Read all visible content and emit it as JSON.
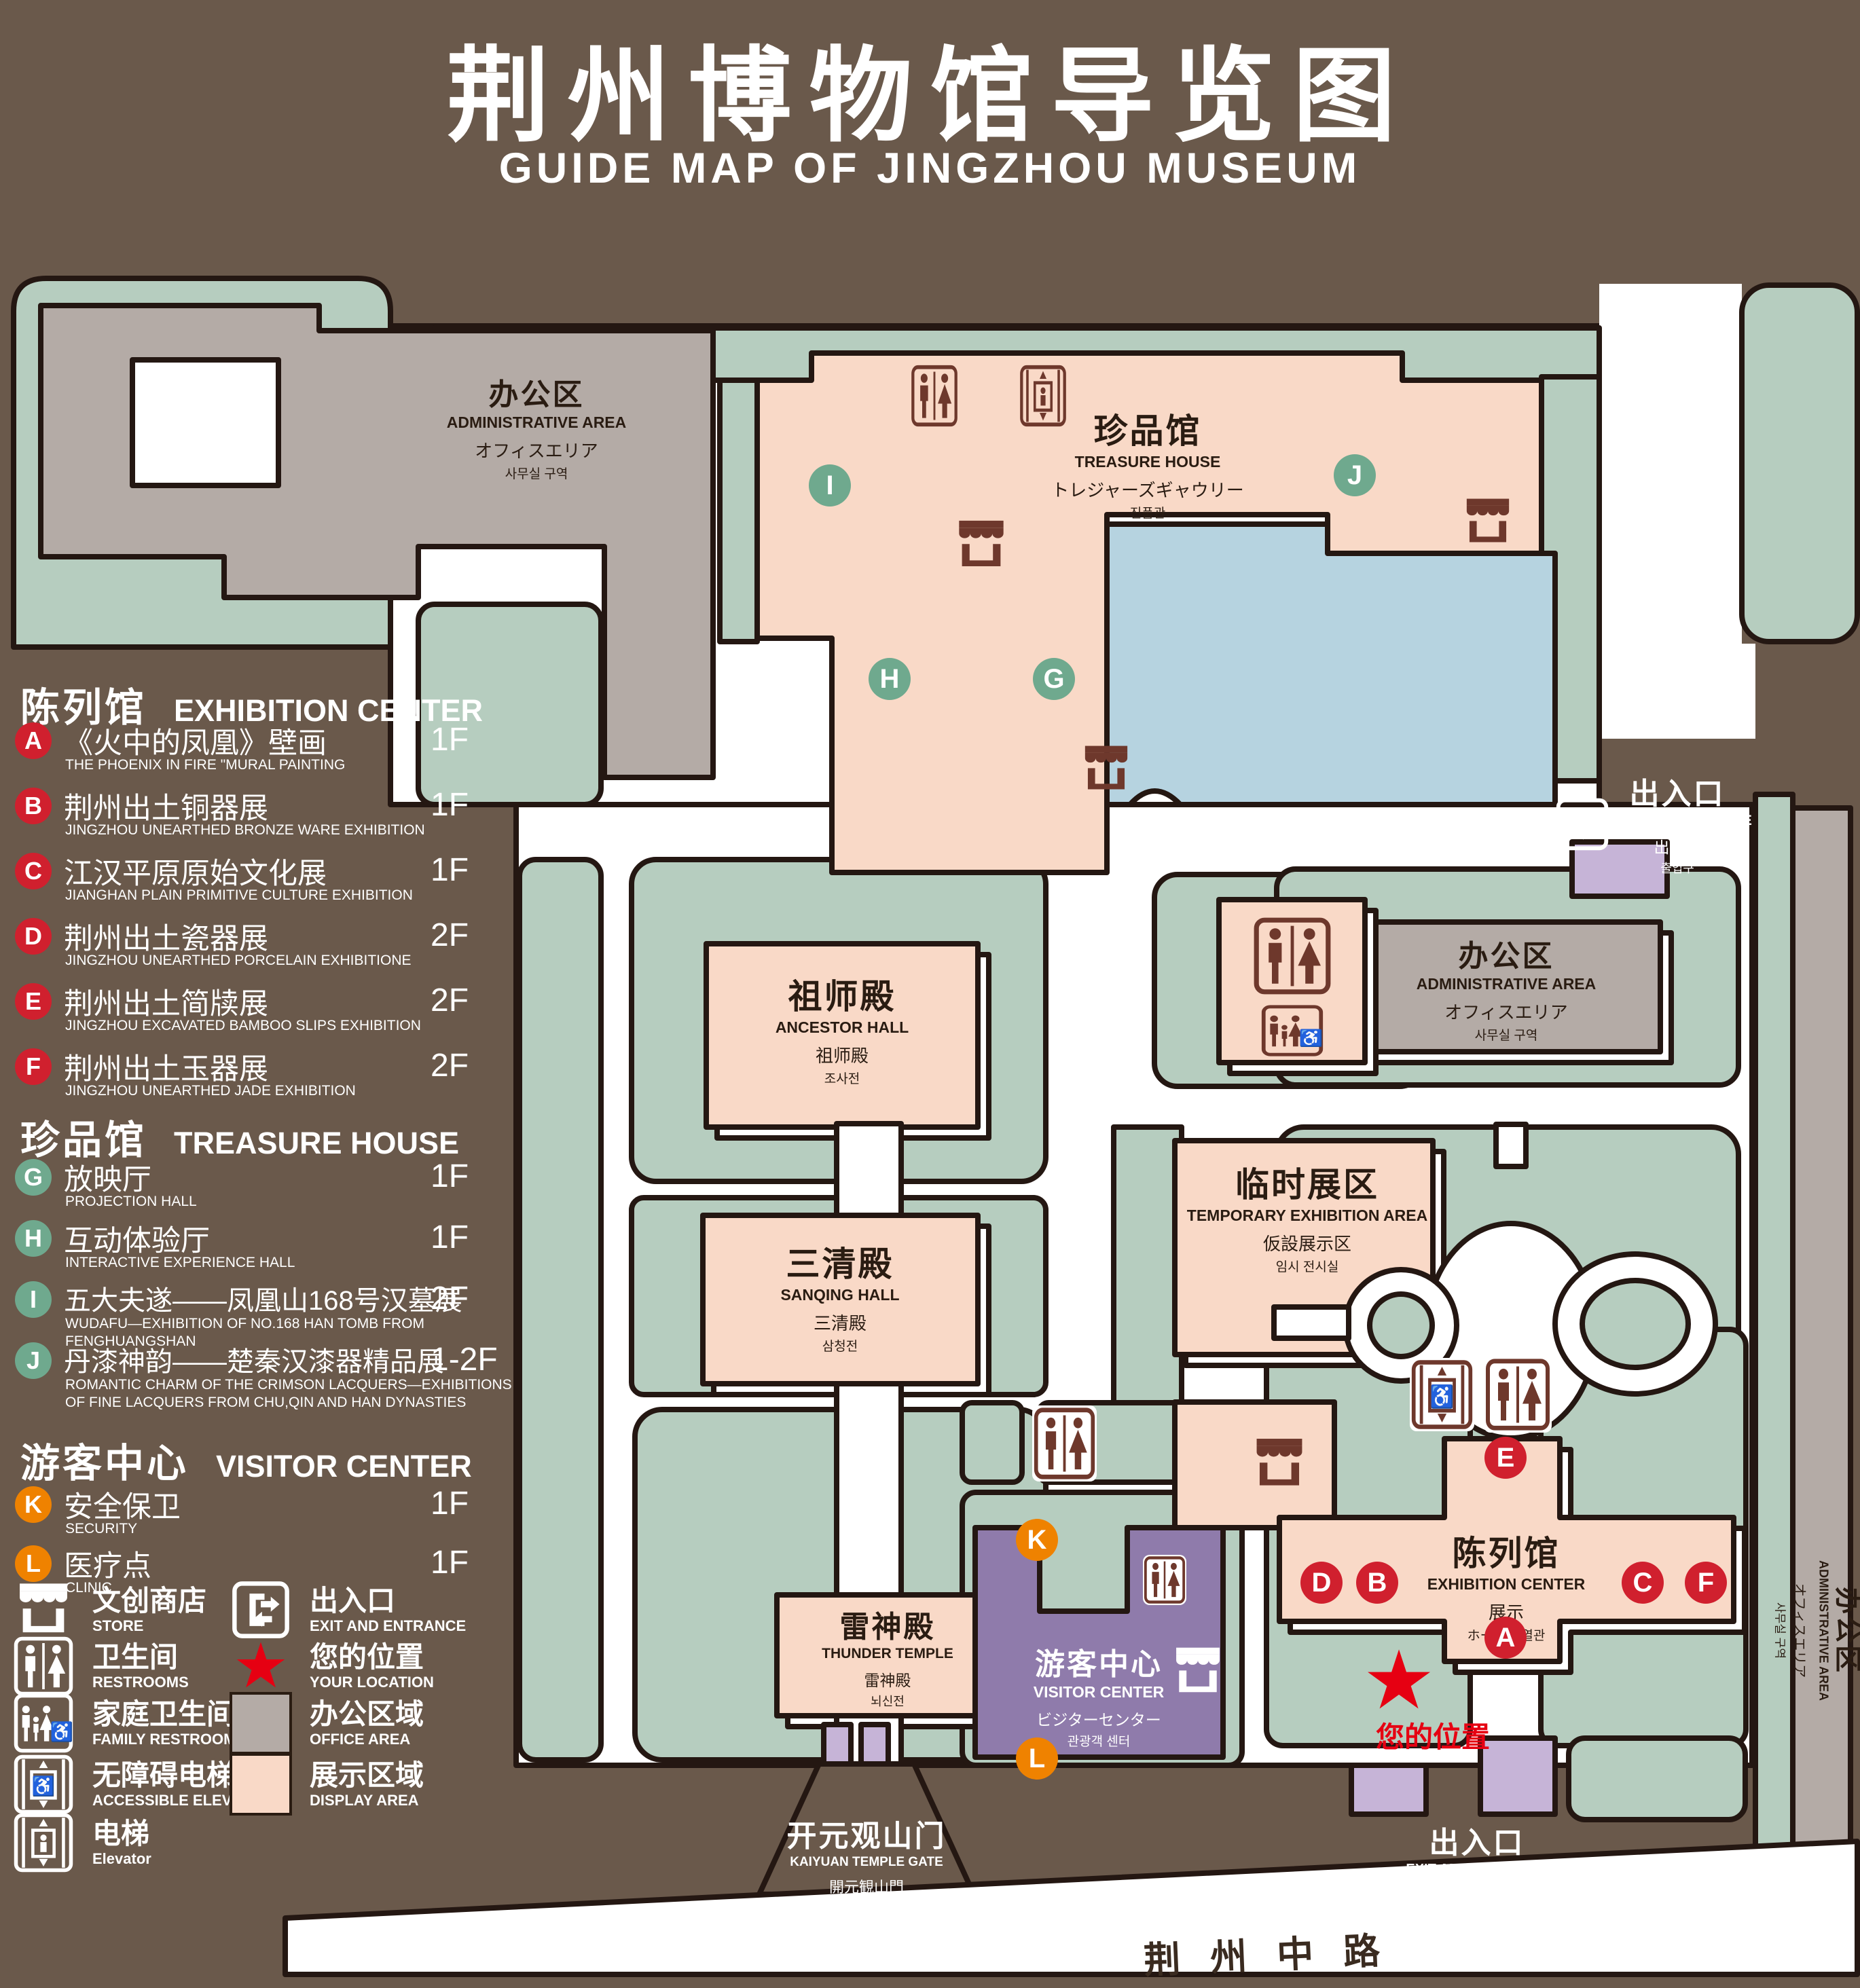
{
  "title": {
    "zh": "荆州博物馆导览图",
    "en": "GUIDE MAP OF JINGZHOU MUSEUM"
  },
  "colors": {
    "background_brown": "#6a594b",
    "green_area": "#b6cdbf",
    "display_area_pink": "#f9d9c7",
    "office_area_gray": "#b4aba6",
    "lake_blue": "#b6d3e0",
    "visitor_center_purple": "#8f7bab",
    "gate_lilac": "#c6b4d7",
    "marker_red": "#d0202e",
    "marker_green": "#6fa98e",
    "marker_orange": "#ef8200",
    "location_red": "#e60012",
    "outline": "#241712"
  },
  "legend": {
    "sections": [
      {
        "zh": "陈列馆",
        "en": "EXHIBITION CENTER",
        "items": [
          {
            "letter": "A",
            "zh": "《火中的凤凰》壁画",
            "en": "THE PHOENIX IN FIRE \"MURAL PAINTING",
            "floor": "1F"
          },
          {
            "letter": "B",
            "zh": "荆州出土铜器展",
            "en": "JINGZHOU UNEARTHED BRONZE WARE EXHIBITION",
            "floor": "1F"
          },
          {
            "letter": "C",
            "zh": "江汉平原原始文化展",
            "en": "JIANGHAN PLAIN PRIMITIVE CULTURE EXHIBITION",
            "floor": "1F"
          },
          {
            "letter": "D",
            "zh": "荆州出土瓷器展",
            "en": "JINGZHOU UNEARTHED PORCELAIN EXHIBITIONE",
            "floor": "2F"
          },
          {
            "letter": "E",
            "zh": "荆州出土简牍展",
            "en": "JINGZHOU EXCAVATED BAMBOO SLIPS EXHIBITION",
            "floor": "2F"
          },
          {
            "letter": "F",
            "zh": "荆州出土玉器展",
            "en": "JINGZHOU UNEARTHED JADE EXHIBITION",
            "floor": "2F"
          }
        ]
      },
      {
        "zh": "珍品馆",
        "en": "TREASURE HOUSE",
        "items": [
          {
            "letter": "G",
            "zh": "放映厅",
            "en": "PROJECTION HALL",
            "floor": "1F"
          },
          {
            "letter": "H",
            "zh": "互动体验厅",
            "en": "INTERACTIVE EXPERIENCE HALL",
            "floor": "1F"
          },
          {
            "letter": "I",
            "zh": "五大夫遂——凤凰山168号汉墓展",
            "en": "WUDAFU—EXHIBITION OF NO.168 HAN TOMB FROM FENGHUANGSHAN",
            "floor": "2F"
          },
          {
            "letter": "J",
            "zh": "丹漆神韵——楚秦汉漆器精品展",
            "en": "ROMANTIC CHARM OF THE CRIMSON LACQUERS—EXHIBITIONS\nOF FINE LACQUERS FROM CHU,QIN AND HAN DYNASTIES",
            "floor": "1-2F"
          }
        ]
      },
      {
        "zh": "游客中心",
        "en": "VISITOR CENTER",
        "items": [
          {
            "letter": "K",
            "zh": "安全保卫",
            "en": "SECURITY",
            "floor": "1F"
          },
          {
            "letter": "L",
            "zh": "医疗点",
            "en": "CLINIC",
            "floor": "1F"
          }
        ]
      }
    ],
    "symbols": [
      {
        "icon": "store-icon",
        "zh": "文创商店",
        "en": "STORE"
      },
      {
        "icon": "restrooms-icon",
        "zh": "卫生间",
        "en": "RESTROOMS"
      },
      {
        "icon": "family-restrooms-icon",
        "zh": "家庭卫生间",
        "en": "FAMILY RESTROOMS"
      },
      {
        "icon": "accessible-elevator-icon",
        "zh": "无障碍电梯",
        "en": "ACCESSIBLE ELEVATOR"
      },
      {
        "icon": "elevator-icon",
        "zh": "电梯",
        "en": "Elevator"
      },
      {
        "icon": "exit-icon",
        "zh": "出入口",
        "en": "EXIT AND ENTRANCE"
      },
      {
        "icon": "your-location-star",
        "zh": "您的位置",
        "en": "YOUR LOCATION"
      },
      {
        "icon": "office-area-swatch",
        "zh": "办公区域",
        "en": "OFFICE AREA"
      },
      {
        "icon": "display-area-swatch",
        "zh": "展示区域",
        "en": "DISPLAY AREA"
      }
    ]
  },
  "map": {
    "buildings": {
      "admin_top_left": {
        "zh": "办公区",
        "en": "ADMINISTRATIVE AREA",
        "ja": "オフィスエリア",
        "ko": "사무실 구역"
      },
      "treasure_house": {
        "zh": "珍品馆",
        "en": "TREASURE HOUSE",
        "ja": "トレジャーズギャウリー",
        "ko": "진품관"
      },
      "admin_right": {
        "zh": "办公区",
        "en": "ADMINISTRATIVE AREA",
        "ja": "オフィスエリア",
        "ko": "사무실 구역"
      },
      "admin_far_right": {
        "zh": "办公区",
        "en": "ADMINISTRATIVE AREA",
        "ja": "オフィスエリア",
        "ko": "사무실 구역"
      },
      "ancestor_hall": {
        "zh": "祖师殿",
        "en": "ANCESTOR HALL",
        "ja": "祖师殿",
        "ko": "조사전"
      },
      "sanqing_hall": {
        "zh": "三清殿",
        "en": "SANQING HALL",
        "ja": "三清殿",
        "ko": "삼청전"
      },
      "thunder_temple": {
        "zh": "雷神殿",
        "en": "THUNDER TEMPLE",
        "ja": "雷神殿",
        "ko": "뇌신전"
      },
      "temporary_exhibition": {
        "zh": "临时展区",
        "en": "TEMPORARY EXHIBITION AREA",
        "ja": "仮設展示区",
        "ko": "임시 전시실"
      },
      "exhibition_center": {
        "zh": "陈列馆",
        "en": "EXHIBITION CENTER",
        "ja": "展示",
        "ko": "ホール 진열관"
      },
      "visitor_center": {
        "zh": "游客中心",
        "en": "VISITOR CENTER",
        "ja": "ビジターセンター",
        "ko": "관광객 센터"
      },
      "kaiyuan_gate": {
        "zh": "开元观山门",
        "en": "KAIYUAN TEMPLE GATE",
        "ja": "開元観山門",
        "ko": "산문을 열다"
      },
      "exit_right": {
        "zh": "出入口",
        "en": "EXIT AND ENTRANCE",
        "ja": "出入口",
        "ko": "출입구"
      },
      "exit_bottom": {
        "zh": "出入口",
        "en": "EXIT AND ENTRANCE",
        "ja": "出入口",
        "ko": "출입구"
      }
    },
    "road": {
      "zh": "荆州中路"
    },
    "your_location": {
      "zh": "您的位置"
    },
    "marker_letters": {
      "A": "A",
      "B": "B",
      "C": "C",
      "D": "D",
      "E": "E",
      "F": "F",
      "G": "G",
      "H": "H",
      "I": "I",
      "J": "J",
      "K": "K",
      "L": "L"
    }
  }
}
